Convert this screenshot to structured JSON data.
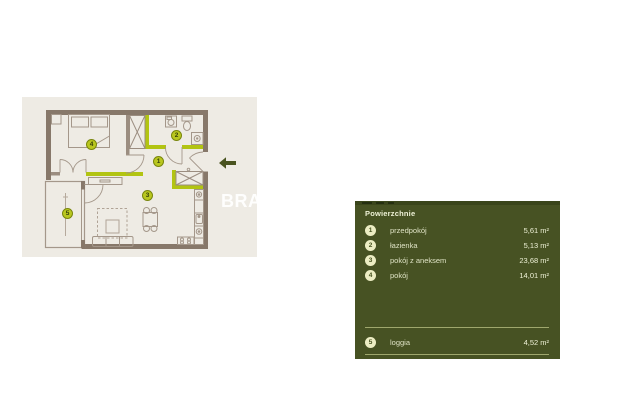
{
  "plan": {
    "watermark": "BRA",
    "markers": [
      {
        "num": "1"
      },
      {
        "num": "2"
      },
      {
        "num": "3"
      },
      {
        "num": "4"
      },
      {
        "num": "5"
      }
    ]
  },
  "icons": {
    "entrance_arrow": "←"
  },
  "legend": {
    "title": "Powierzchnie",
    "rows": [
      {
        "num": "1",
        "label": "przedpokój",
        "area": "5,61 m²"
      },
      {
        "num": "2",
        "label": "łazienka",
        "area": "5,13 m²"
      },
      {
        "num": "3",
        "label": "pokój z aneksem",
        "area": "23,68 m²"
      },
      {
        "num": "4",
        "label": "pokój",
        "area": "14,01 m²"
      },
      {
        "num": "5",
        "label": "loggia",
        "area": "4,52 m²"
      }
    ]
  },
  "colors": {
    "page_bg": "#ffffff",
    "plan_bg": "#eeebe4",
    "wall_brown": "#87786a",
    "accent_lime": "#b2c412",
    "marker_fill": "#b9c71f",
    "panel_bg": "#475223",
    "panel_text": "#e3e7c8",
    "legend_circle": "#ecedc3",
    "divider": "#9fa76d",
    "arrow_olive": "#4a5420"
  }
}
